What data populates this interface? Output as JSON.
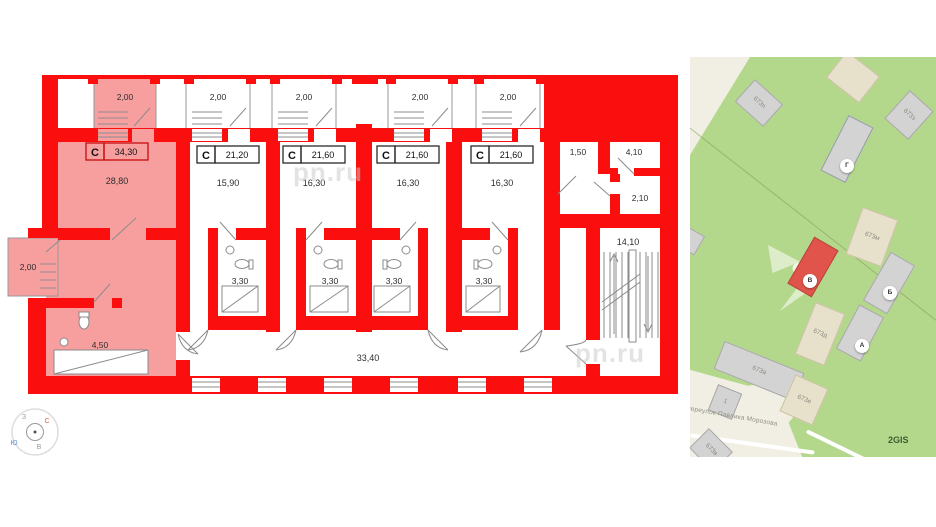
{
  "floorplan": {
    "units": [
      {
        "type": "C",
        "total": "34,30",
        "room_area": "28,80",
        "balcony": "2,00",
        "balcony_side": "2,00",
        "bathroom": "4,50"
      },
      {
        "type": "C",
        "total": "21,20",
        "room_area": "15,90",
        "balcony": "2,00",
        "bathroom": "3,30"
      },
      {
        "type": "C",
        "total": "21,60",
        "room_area": "16,30",
        "balcony": "2,00",
        "bathroom": "3,30"
      },
      {
        "type": "C",
        "total": "21,60",
        "room_area": "16,30",
        "balcony": "2,00",
        "bathroom": "3,30"
      },
      {
        "type": "C",
        "total": "21,60",
        "room_area": "16,30",
        "balcony": "2,00",
        "bathroom": "3,30"
      }
    ],
    "corridor_area": "33,40",
    "stairwell_area": "14,10",
    "service_rooms": [
      {
        "area": "1,50"
      },
      {
        "area": "4,10"
      },
      {
        "area": "2,10"
      }
    ],
    "compass": {
      "north": "С",
      "south": "Ю",
      "west": "З",
      "east": "В"
    },
    "watermark": "pn.ru"
  },
  "map": {
    "street_label": "переулок Павлика Морозова",
    "attribution": "2GIS",
    "markers": [
      {
        "label": "Г"
      },
      {
        "label": "В"
      },
      {
        "label": "Б"
      },
      {
        "label": "А"
      }
    ],
    "buildings": {
      "b673p": "673п",
      "b673z": "673з",
      "b673m": "673м",
      "b673d": "673д",
      "b673a": "673а",
      "b673e": "673е",
      "b673v": "673в",
      "b1": "1"
    },
    "colors": {
      "wall": "#fb0e0e",
      "highlight": "#f79e9e",
      "land_green": "#b4d88b",
      "land_beige": "#f1efe3",
      "building_gray": "#d3d3d3",
      "building_beige": "#e7e0ca",
      "selected_building": "#e0544b"
    }
  }
}
